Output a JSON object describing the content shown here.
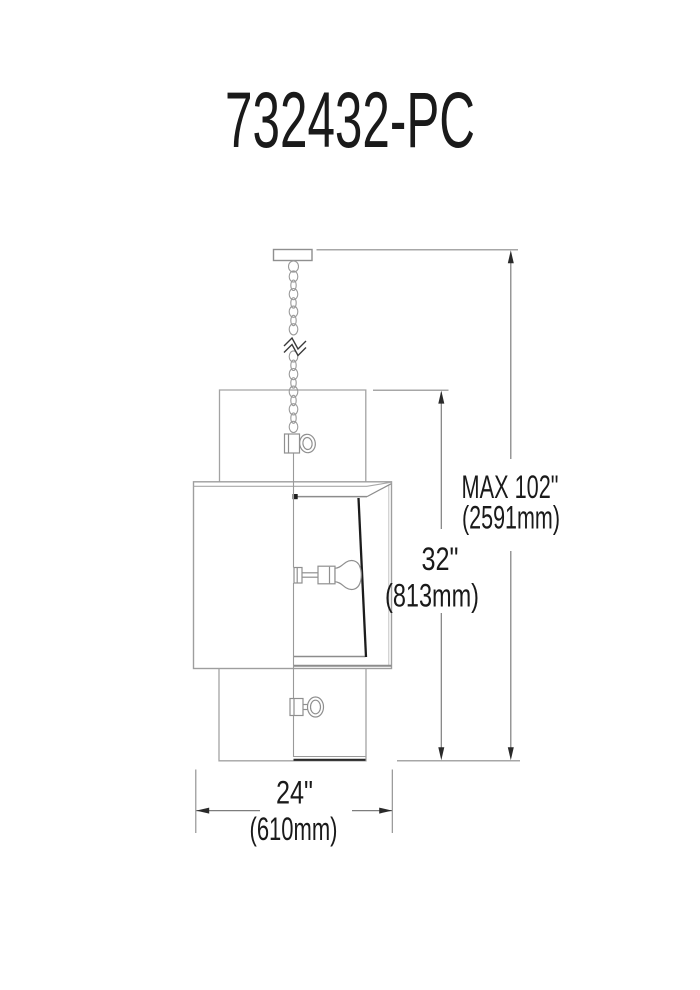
{
  "title": "732432-PC",
  "dimensions": {
    "overall": {
      "imperial": "MAX 102\"",
      "metric": "(2591mm)"
    },
    "shade_height": {
      "imperial": "32\"",
      "metric": "(813mm)"
    },
    "width": {
      "imperial": "24\"",
      "metric": "(610mm)"
    }
  },
  "colors": {
    "background": "#ffffff",
    "fixture_line": "#9a9a9a",
    "dark_accent": "#1c1c1c",
    "dimension_line": "#7d7d7d",
    "arrow": "#2a2a2a",
    "text": "#1a1a1a"
  }
}
